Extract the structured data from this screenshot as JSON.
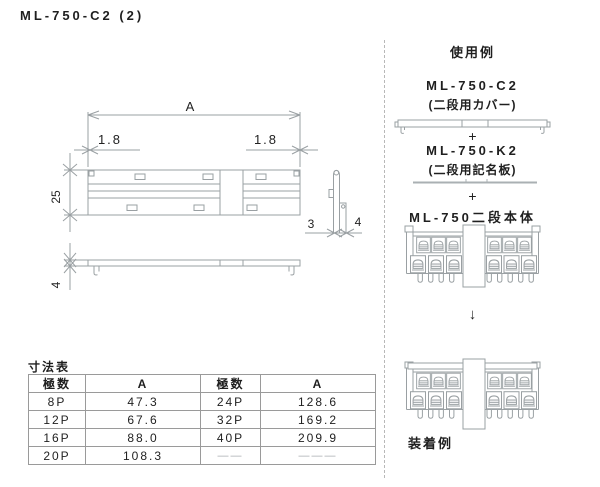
{
  "title": "ML-750-C2 (2)",
  "drawing": {
    "dim_a": "A",
    "dim_left_offset": "1.8",
    "dim_right_offset": "1.8",
    "dim_height": "25",
    "dim_side_top": "3",
    "dim_side_base": "4",
    "dim_plate_height": "4"
  },
  "dim_table": {
    "title": "寸法表",
    "col_headers": [
      "極数",
      "A",
      "極数",
      "A"
    ],
    "rows": [
      [
        "8P",
        "47.3",
        "24P",
        "128.6"
      ],
      [
        "12P",
        "67.6",
        "32P",
        "169.2"
      ],
      [
        "16P",
        "88.0",
        "40P",
        "209.9"
      ],
      [
        "20P",
        "108.3",
        "——",
        "———"
      ]
    ]
  },
  "usage": {
    "title": "使用例",
    "cover_name": "ML-750-C2",
    "cover_desc": "(二段用カバー)",
    "plus_1": "+",
    "plate_name": "ML-750-K2",
    "plate_desc": "(二段用記名板)",
    "plus_2": "+",
    "body_name": "ML-750二段本体",
    "down_arrow": "↓",
    "mounted_label": "装着例"
  },
  "colors": {
    "line": "#9aa0a3",
    "text": "#222222"
  }
}
